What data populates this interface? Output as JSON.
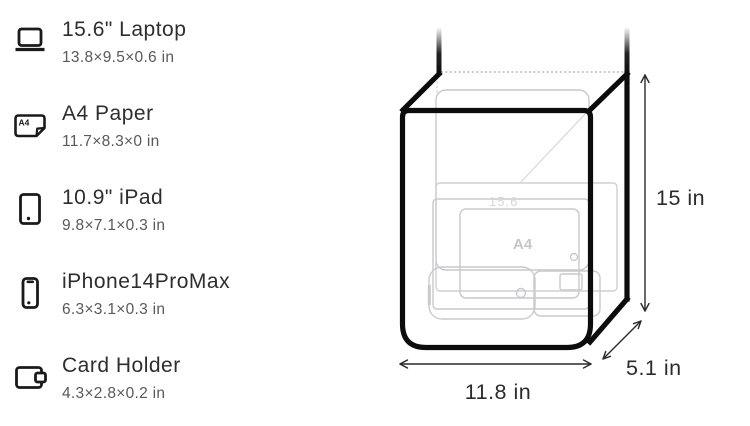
{
  "item_list": {
    "items": [
      {
        "title": "15.6\" Laptop",
        "dims": "13.8×9.5×0.6 in",
        "icon": "laptop-icon"
      },
      {
        "title": "A4 Paper",
        "dims": "11.7×8.3×0 in",
        "icon": "a4-paper-icon"
      },
      {
        "title": "10.9\" iPad",
        "dims": "9.8×7.1×0.3 in",
        "icon": "tablet-icon"
      },
      {
        "title": "iPhone14ProMax",
        "dims": "6.3×3.1×0.3 in",
        "icon": "phone-icon"
      },
      {
        "title": "Card Holder",
        "dims": "4.3×2.8×0.2 in",
        "icon": "wallet-icon"
      }
    ],
    "icon_a4_text": "A4"
  },
  "diagram": {
    "height_label": "15 in",
    "width_label": "11.8 in",
    "depth_label": "5.1 in",
    "inner_laptop_label": "15.6",
    "inner_a4_label": "A4",
    "line_color": "#0c0c0c",
    "faint_color": "#c9c9cd",
    "label_color": "#2b2b2b"
  }
}
